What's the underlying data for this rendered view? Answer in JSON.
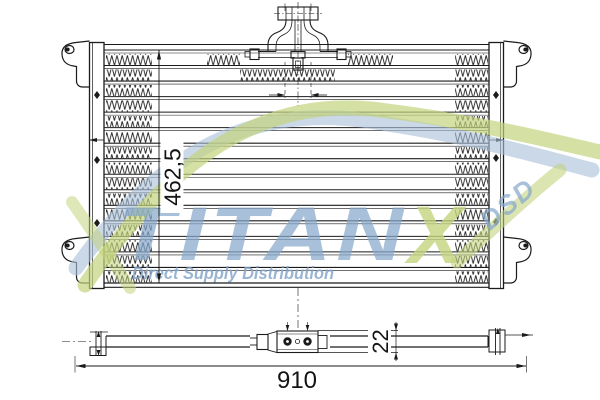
{
  "dimensions": {
    "height": "462,5",
    "width": "910",
    "depth": "22"
  },
  "watermark": {
    "brand": "TITAN",
    "brand_suffix": "X",
    "abbr": "DSD",
    "tagline": "Direct Supply Distribution",
    "brand_color": "#87a7cb",
    "accent_color": "#c3d47e"
  },
  "colors": {
    "line": "#1b1b1b",
    "background": "#ffffff"
  }
}
